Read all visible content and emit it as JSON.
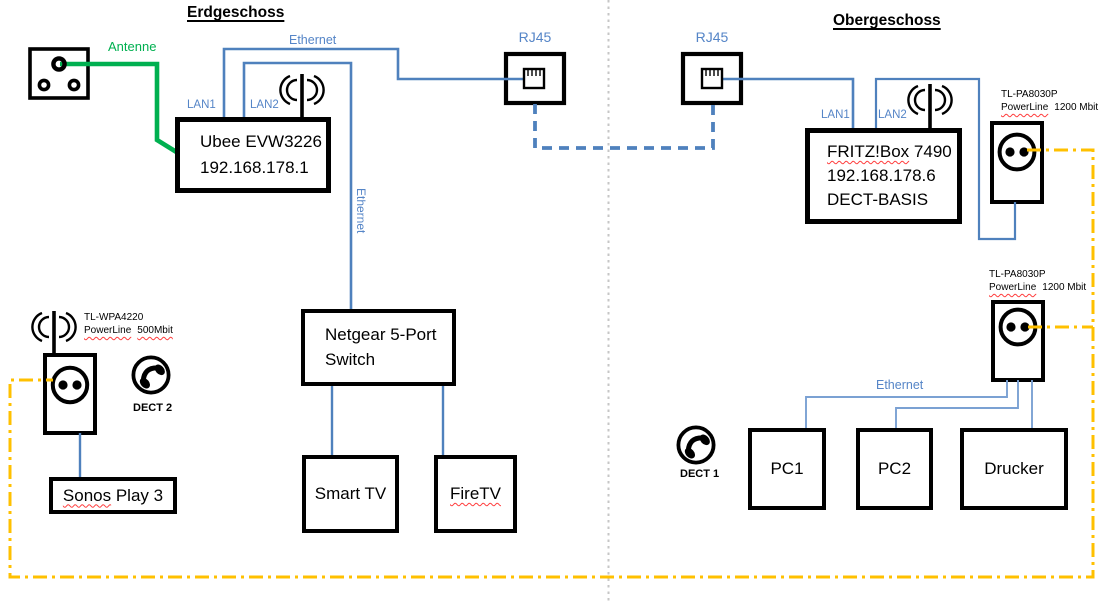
{
  "titles": {
    "left": "Erdgeschoss",
    "right": "Obergeschoss"
  },
  "net_labels": {
    "antenna": "Antenne",
    "ethernet_top": "Ethernet",
    "ethernet_vertical": "Ethernet",
    "ethernet_right": "Ethernet",
    "lan1_left": "LAN1",
    "lan2_left": "LAN2",
    "lan1_right": "LAN1",
    "lan2_right": "LAN2",
    "rj45_left": "RJ45",
    "rj45_right": "RJ45"
  },
  "devices": {
    "ubee": {
      "name": "Ubee EVW3226",
      "ip": "192.168.178.1"
    },
    "fritzbox": {
      "name": "FRITZ!Box",
      "model": "7490",
      "ip": "192.168.178.6",
      "extra": "DECT-BASIS"
    },
    "netgear": {
      "line1": "Netgear 5-Port",
      "line2": "Switch"
    },
    "smart_tv": {
      "label": "Smart TV"
    },
    "fire_tv": {
      "label": "FireTV"
    },
    "sonos": {
      "brand": "Sonos",
      "rest": "Play 3"
    },
    "pc1": {
      "label": "PC1"
    },
    "pc2": {
      "label": "PC2"
    },
    "drucker": {
      "label": "Drucker"
    },
    "wpa4220": {
      "model": "TL-WPA4220",
      "tech": "PowerLine",
      "speed": "500Mbit"
    },
    "pa8030p_upper": {
      "model": "TL-PA8030P",
      "tech": "PowerLine",
      "speed": "1200 Mbit"
    },
    "pa8030p_lower": {
      "model": "TL-PA8030P",
      "tech": "PowerLine",
      "speed": "1200 Mbit"
    },
    "dect1": {
      "label": "DECT 1"
    },
    "dect2": {
      "label": "DECT 2"
    }
  },
  "colors": {
    "ethernet_line": "#4f81bd",
    "ethernet_light": "#7ba1d3",
    "label_blue": "#5585c7",
    "antenna_green": "#00b050",
    "powerline_yellow": "#ffc000",
    "divider_gray": "#c6c6c6",
    "spellcheck_red": "#ff3b3b"
  }
}
